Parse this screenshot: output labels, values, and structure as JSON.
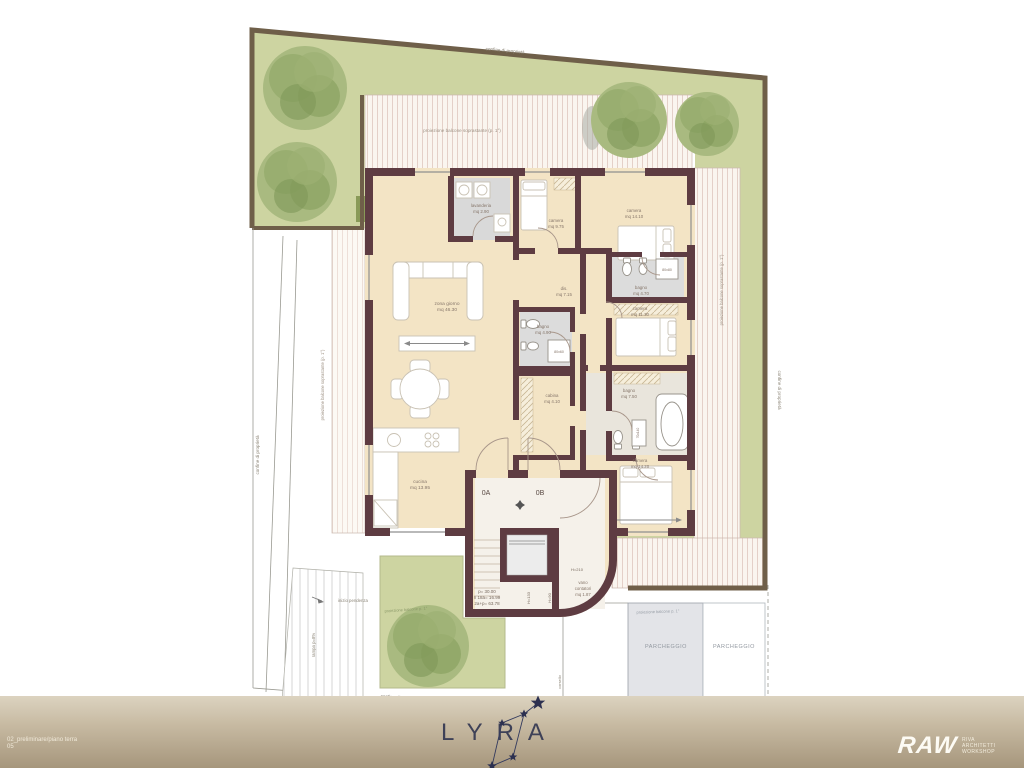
{
  "colors": {
    "garden": "#cdd4a1",
    "garden_border": "#6f5f49",
    "wall": "#5e3c42",
    "floor": "#f3e4c5",
    "bath_floor": "#dcdcdc",
    "deck_line": "#e4d0c8",
    "footer_top": "#dcd3c0",
    "footer_bottom": "#a6967c",
    "logo_text": "#3e4157",
    "star": "#2c3050"
  },
  "boundaries": {
    "top": "confine di proprietà",
    "right": "confine di proprietà",
    "left": "confine di proprietà",
    "bottom": "confine di proprietà"
  },
  "projections": {
    "top": "proiezione balcone soprastante (p. 1°)",
    "right": "proiezione balcone soprastante (p. 1°)",
    "left": "proiezione balcone soprastante (p. 1°)",
    "parking": "proiezione balcone p. 1°",
    "garden": "proiezione balcone p. 1°"
  },
  "site": {
    "parking_left": "PARCHEGGIO",
    "parking_right": "PARCHEGGIO",
    "ramp_start": "inizio pendenza",
    "ramp_slope": "rampa p=8%",
    "driveway": "corsello"
  },
  "units": {
    "a": "0A",
    "b": "0B"
  },
  "stairs": {
    "line1": "p= 30.00",
    "line2": "n 18a= 16.99",
    "line3": "2a+p= 63.78",
    "h_door": "H=210",
    "h1": "H=133",
    "h2": "H=90"
  },
  "rooms": {
    "living": {
      "name": "zona giorno",
      "area": "mq 46.30"
    },
    "kitchen": {
      "name": "cucina",
      "area": "mq 13.95"
    },
    "laundry": {
      "name": "lavanderia",
      "area": "mq 2.90"
    },
    "camera1": {
      "name": "camera",
      "area": "mq 9.75"
    },
    "camera2": {
      "name": "camera",
      "area": "mq 14.10"
    },
    "bath1": {
      "name": "bagno",
      "area": "mq 4.70"
    },
    "hall": {
      "name": "dis.",
      "area": "mq 7.15"
    },
    "bath2": {
      "name": "bagno",
      "area": "mq 4.90"
    },
    "closet": {
      "name": "cabina",
      "area": "mq 4.10"
    },
    "camera3": {
      "name": "camera",
      "area": "mq 11.30"
    },
    "bath3": {
      "name": "bagno",
      "area": "mq 7.50"
    },
    "camera4": {
      "name": "camera",
      "area": "mq 14.20"
    },
    "meters": {
      "l1": "vano",
      "l2": "contatori",
      "l3": "mq 1.87"
    }
  },
  "fixtures": {
    "shower1": "80x80",
    "shower2": "80x60",
    "tub": "70x140"
  },
  "footer": {
    "project": "LYRA",
    "sheet_line1": "02_preliminare/piano terra",
    "sheet_line2": "05",
    "logo": "RAW",
    "logo_sub1": "RIVA",
    "logo_sub2": "ARCHITETTI",
    "logo_sub3": "WORKSHOP"
  }
}
